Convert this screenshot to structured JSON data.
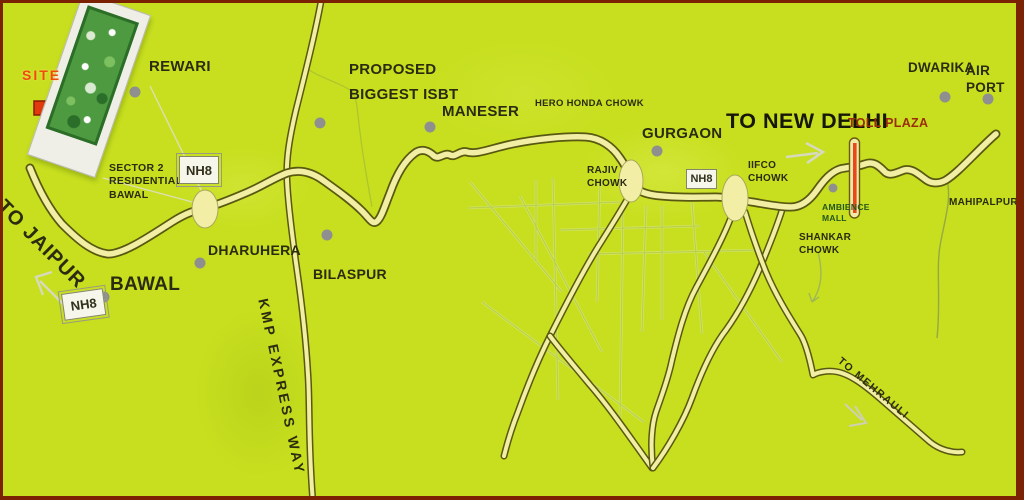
{
  "places": {
    "rewari": "REWARI",
    "sector2_bawal": "SECTOR 2\nRESIDENTIAL\nBAWAL",
    "bawal": "BAWAL",
    "dharuhera": "DHARUHERA",
    "bilaspur": "BILASPUR",
    "proposed_isbt": "PROPOSED\nBIGGEST ISBT",
    "maneser": "MANESER",
    "hero_honda_chowk": "HERO HONDA CHOWK",
    "gurgaon": "GURGAON",
    "dwarika": "DWARIKA",
    "airport": "AIR PORT",
    "mahipalpur": "MAHIPALPUR"
  },
  "junctions": {
    "rajiv_chowk": "RAJIV\nCHOWK",
    "iifco_chowk": "IIFCO\nCHOWK",
    "ambience_mall": "AMBIENCE\nMALL",
    "shankar_chowk": "SHANKAR\nCHOWK"
  },
  "directions": {
    "to_jaipur": "TO JAIPUR",
    "to_new_delhi": "TO NEW DELHI",
    "to_mehrauli": "TO MEHRAULI",
    "kmp_express_way": "KMP EXPRESS WAY"
  },
  "markers": {
    "site": "SITE",
    "toll_plaza": "TOLL PLAZA"
  },
  "badges": {
    "nh8": "NH8"
  },
  "colors": {
    "background": "#c7df1e",
    "road_fill": "#f2efa4",
    "road_outline": "#585812",
    "border": "#7b2104",
    "toll_bar_red": "#e8481c",
    "toll_text": "#9b2d0a",
    "site_text": "#ee4b0c",
    "site_arrow": "#e23a0c",
    "label_text": "#2b2b10",
    "city_dot": "#8f8f8f"
  }
}
